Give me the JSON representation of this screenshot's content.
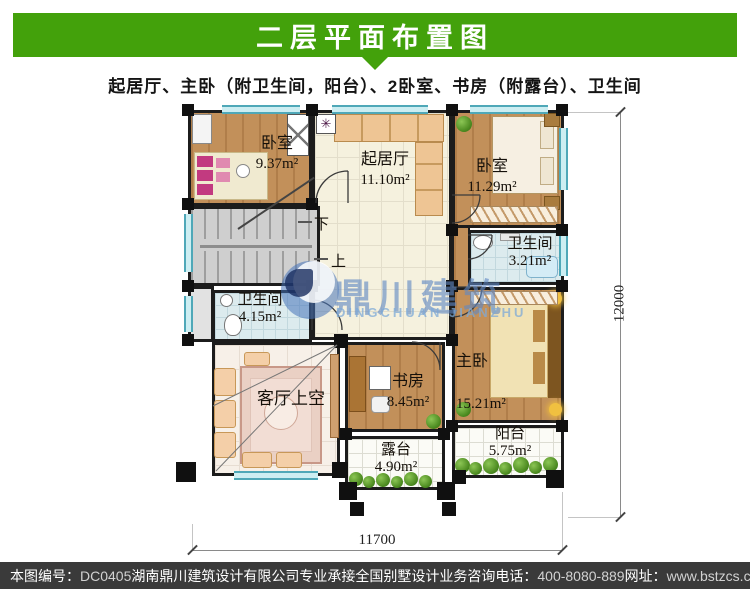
{
  "header": {
    "title": "二层平面布置图"
  },
  "subtitle": "起居厅、主卧（附卫生间，阳台）、2卧室、书房（附露台）、卫生间",
  "watermark": {
    "cn": "鼎川建筑",
    "en": "DINGCHUAN JIANZHU"
  },
  "icons": {
    "plant_star": "✳"
  },
  "plan": {
    "rooms": [
      {
        "name": "卧室",
        "area": "9.37m²"
      },
      {
        "name": "起居厅",
        "area": "11.10m²"
      },
      {
        "name": "卧室",
        "area": "11.29m²"
      },
      {
        "name": "卫生间",
        "area": "3.21m²"
      },
      {
        "name": "卫生间",
        "area": "4.15m²"
      },
      {
        "name": "客厅上空",
        "area": ""
      },
      {
        "name": "书房",
        "area": "8.45m²"
      },
      {
        "name": "主卧",
        "area": "15.21m²"
      },
      {
        "name": "阳台",
        "area": "5.75m²"
      },
      {
        "name": "露台",
        "area": "4.90m²"
      }
    ],
    "stairs": {
      "down": "下",
      "up": "上"
    },
    "dimensions": {
      "right": "12000",
      "bottom": "11700"
    }
  },
  "footer": {
    "items": [
      {
        "label": "本图编号：",
        "value": "DC0405"
      },
      {
        "label": "湖南鼎川建筑设计有限公司专业承接全国别墅设计业务",
        "value": ""
      },
      {
        "label": "咨询电话：",
        "value": "400-8080-889"
      },
      {
        "label": "网址：",
        "value": "www.bstzcs.com"
      }
    ]
  },
  "colors": {
    "header_green": "#43a10b",
    "footer_dark": "#3a3a3a",
    "watermark_blue": "#5f87c3",
    "window_teal": "#4fa8b8"
  }
}
